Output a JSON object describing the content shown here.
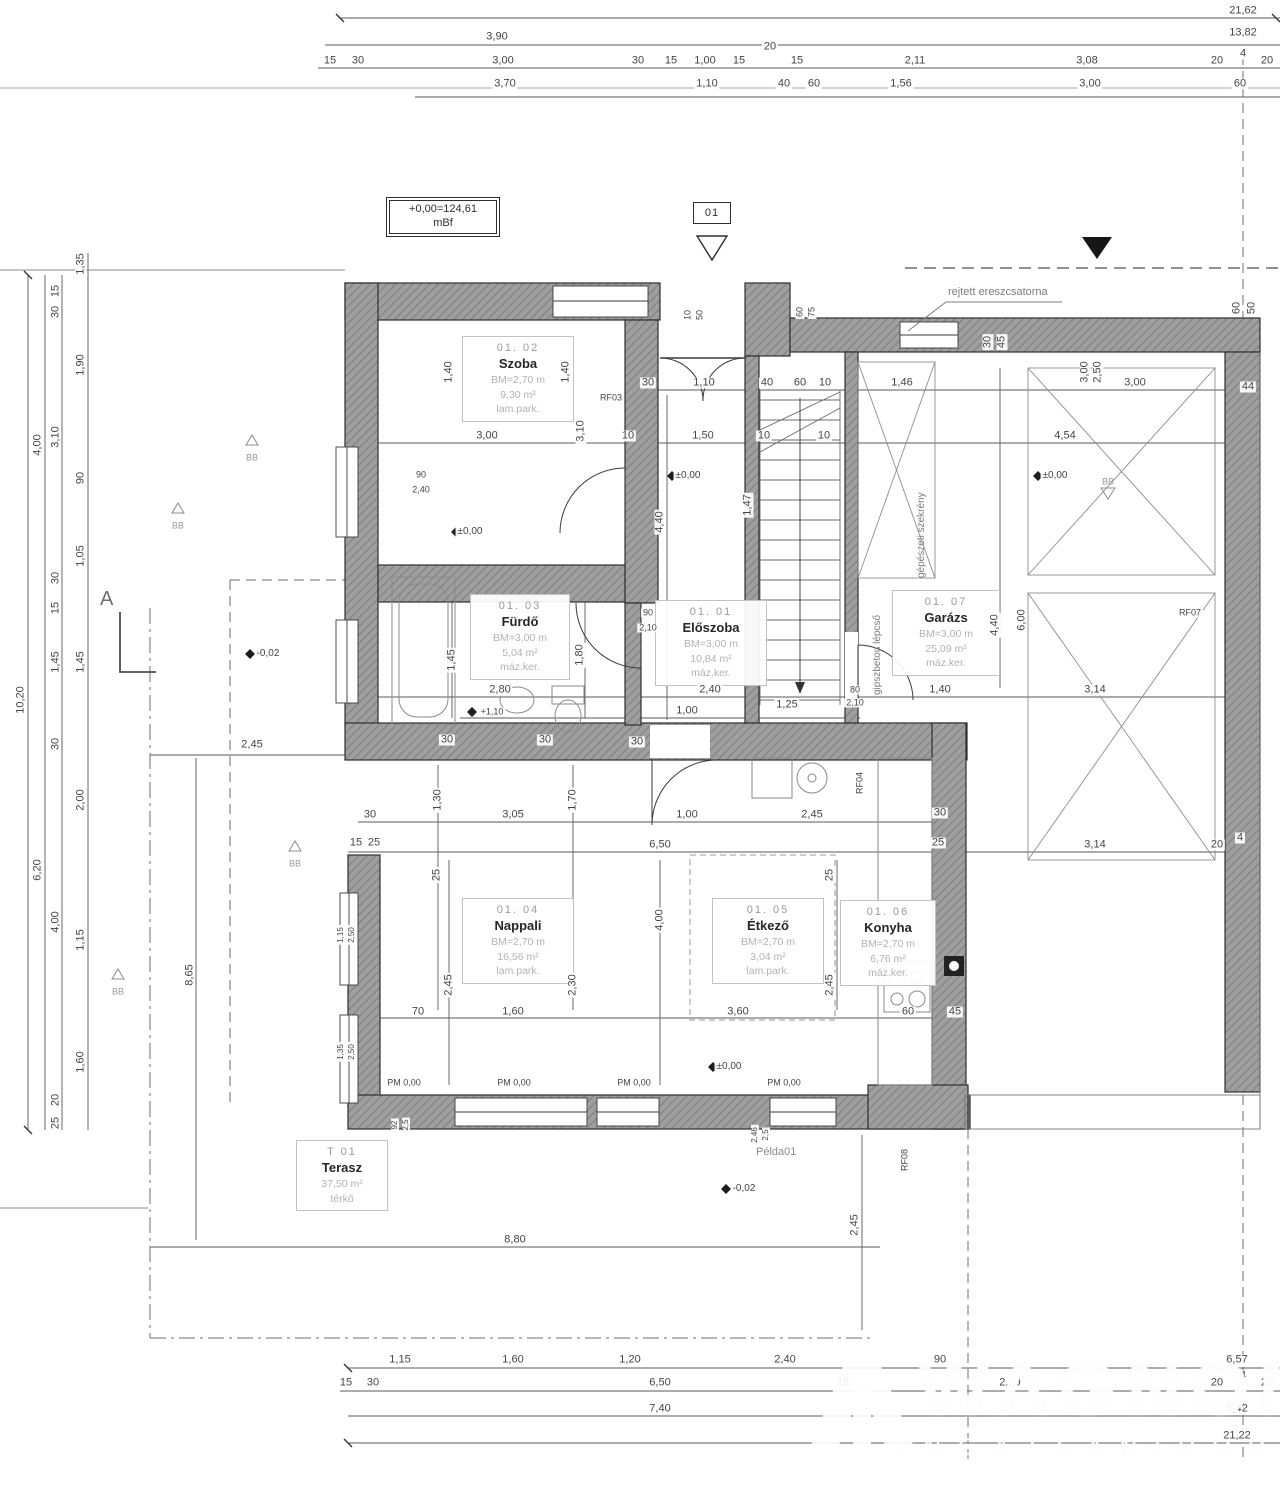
{
  "level_box": {
    "line1": "+0,00=124,61",
    "line2": "mBf"
  },
  "section_tag": "01",
  "section_letter": "A",
  "notes": {
    "gutter": "rejtett ereszcsatorna",
    "stairs": "gipszbeton lépcső",
    "closet": "gépészeti szekrény",
    "sample": "Példa01"
  },
  "watermark": {
    "line1": "WAGNON",
    "line2": "INGATLANIRODA"
  },
  "colors": {
    "wall_fill": "#9f9f9f",
    "wall_hatch": "#878787",
    "line": "#555555",
    "text": "#454545",
    "muted": "#a8a8a8"
  },
  "rooms": [
    {
      "num": "01. 01",
      "name": "Előszoba",
      "height": "BM=3,00 m",
      "area": "10,84 m²",
      "floor": "máz.ker."
    },
    {
      "num": "01. 02",
      "name": "Szoba",
      "height": "BM=2,70 m",
      "area": "9,30 m²",
      "floor": "lam.park."
    },
    {
      "num": "01. 03",
      "name": "Fürdő",
      "height": "BM=3,00 m",
      "area": "5,04 m²",
      "floor": "máz.ker."
    },
    {
      "num": "01. 04",
      "name": "Nappali",
      "height": "BM=2,70 m",
      "area": "16,56 m²",
      "floor": "lam.park."
    },
    {
      "num": "01. 05",
      "name": "Étkező",
      "height": "BM=2,70 m",
      "area": "3,04 m²",
      "floor": "lam.park."
    },
    {
      "num": "01. 06",
      "name": "Konyha",
      "height": "BM=2,70 m",
      "area": "6,76 m²",
      "floor": "máz.ker."
    },
    {
      "num": "01. 07",
      "name": "Garázs",
      "height": "BM=3,00 m",
      "area": "25,09 m²",
      "floor": "máz.ker."
    },
    {
      "num": "T 01",
      "name": "Terasz",
      "height": "",
      "area": "37,50 m²",
      "floor": "térkő"
    }
  ],
  "dims": [
    [
      1243,
      11,
      "21,62"
    ],
    [
      497,
      37,
      "3,90"
    ],
    [
      1243,
      33,
      "13,82"
    ],
    [
      330,
      61,
      "15"
    ],
    [
      358,
      61,
      "30"
    ],
    [
      503,
      61,
      "3,00"
    ],
    [
      638,
      61,
      "30"
    ],
    [
      671,
      61,
      "15"
    ],
    [
      705,
      61,
      "1,00"
    ],
    [
      739,
      61,
      "15"
    ],
    [
      770,
      47,
      "20"
    ],
    [
      797,
      61,
      "15"
    ],
    [
      915,
      61,
      "2,11"
    ],
    [
      1087,
      61,
      "3,08"
    ],
    [
      1217,
      61,
      "20"
    ],
    [
      1243,
      54,
      "4"
    ],
    [
      1267,
      61,
      "20"
    ],
    [
      505,
      84,
      "3,70"
    ],
    [
      707,
      84,
      "1,10"
    ],
    [
      784,
      84,
      "40"
    ],
    [
      814,
      84,
      "60"
    ],
    [
      901,
      84,
      "1,56"
    ],
    [
      1090,
      84,
      "3,00"
    ],
    [
      1240,
      84,
      "60"
    ],
    [
      21,
      700,
      "10,20",
      1
    ],
    [
      38,
      445,
      "4,00",
      1
    ],
    [
      38,
      870,
      "6,20",
      1
    ],
    [
      56,
      291,
      "15",
      1
    ],
    [
      56,
      312,
      "30",
      1
    ],
    [
      56,
      437,
      "3,10",
      1
    ],
    [
      56,
      578,
      "30",
      1
    ],
    [
      56,
      608,
      "15",
      1
    ],
    [
      56,
      662,
      "1,45",
      1
    ],
    [
      56,
      744,
      "30",
      1
    ],
    [
      56,
      922,
      "4,00",
      1
    ],
    [
      56,
      1100,
      "20",
      1
    ],
    [
      56,
      1123,
      "25",
      1
    ],
    [
      81,
      264,
      "1,35",
      1
    ],
    [
      81,
      365,
      "1,90",
      1
    ],
    [
      81,
      478,
      "90",
      1
    ],
    [
      81,
      556,
      "1,05",
      1
    ],
    [
      81,
      662,
      "1,45",
      1
    ],
    [
      81,
      800,
      "2,00",
      1
    ],
    [
      81,
      940,
      "1,15",
      1
    ],
    [
      81,
      1062,
      "1,60",
      1
    ],
    [
      400,
      1360,
      "1,15"
    ],
    [
      513,
      1360,
      "1,60"
    ],
    [
      630,
      1360,
      "1,20"
    ],
    [
      785,
      1360,
      "2,40"
    ],
    [
      940,
      1360,
      "90"
    ],
    [
      1237,
      1360,
      "6,57"
    ],
    [
      346,
      1383,
      "15"
    ],
    [
      373,
      1383,
      "30"
    ],
    [
      660,
      1383,
      "6,50"
    ],
    [
      843,
      1383,
      "15"
    ],
    [
      1010,
      1383,
      "2,19"
    ],
    [
      1217,
      1383,
      "20"
    ],
    [
      1243,
      1376,
      "4"
    ],
    [
      1267,
      1383,
      "20"
    ],
    [
      660,
      1409,
      "7,40"
    ],
    [
      1237,
      1409,
      "6,42"
    ],
    [
      1237,
      1436,
      "21,22"
    ],
    [
      252,
      745,
      "2,45"
    ],
    [
      190,
      975,
      "8,65",
      1
    ],
    [
      515,
      1240,
      "8,80"
    ],
    [
      855,
      1225,
      "2,45",
      1
    ],
    [
      648,
      383,
      "30"
    ],
    [
      704,
      383,
      "1,10"
    ],
    [
      767,
      383,
      "40"
    ],
    [
      800,
      383,
      "60"
    ],
    [
      825,
      383,
      "10"
    ],
    [
      902,
      383,
      "1,46"
    ],
    [
      1135,
      383,
      "3,00"
    ],
    [
      1248,
      387,
      "44"
    ],
    [
      487,
      436,
      "3,00"
    ],
    [
      581,
      431,
      "3,10",
      1
    ],
    [
      628,
      436,
      "10"
    ],
    [
      703,
      436,
      "1,50"
    ],
    [
      764,
      436,
      "10"
    ],
    [
      824,
      436,
      "10"
    ],
    [
      1065,
      436,
      "4,54"
    ],
    [
      449,
      372,
      "1,40",
      1
    ],
    [
      566,
      372,
      "1,40",
      1
    ],
    [
      660,
      522,
      "4,40",
      1
    ],
    [
      748,
      505,
      "1,47",
      1
    ],
    [
      452,
      660,
      "1,45",
      1
    ],
    [
      580,
      655,
      "1,80",
      1
    ],
    [
      995,
      625,
      "4,40",
      1
    ],
    [
      1022,
      620,
      "6,00",
      1
    ],
    [
      1237,
      308,
      "60",
      1
    ],
    [
      1252,
      308,
      "50",
      1
    ],
    [
      1085,
      372,
      "3,00",
      1
    ],
    [
      1098,
      372,
      "2,50",
      1
    ],
    [
      988,
      342,
      "30",
      1
    ],
    [
      1002,
      342,
      "45",
      1
    ],
    [
      688,
      315,
      "10",
      1,
      9
    ],
    [
      700,
      315,
      "50",
      1,
      9
    ],
    [
      800,
      312,
      "60",
      1,
      9
    ],
    [
      812,
      312,
      "75",
      1,
      9
    ],
    [
      611,
      398,
      "RF03",
      0,
      9
    ],
    [
      648,
      613,
      "90",
      0,
      9
    ],
    [
      648,
      628,
      "2,10",
      0,
      9
    ],
    [
      855,
      690,
      "80",
      0,
      9
    ],
    [
      855,
      703,
      "2,10",
      0,
      9
    ],
    [
      421,
      475,
      "90",
      0,
      9
    ],
    [
      421,
      490,
      "2,40",
      0,
      9
    ],
    [
      500,
      690,
      "2,80"
    ],
    [
      710,
      690,
      "2,40"
    ],
    [
      940,
      690,
      "1,40"
    ],
    [
      1095,
      690,
      "3,14"
    ],
    [
      687,
      711,
      "1,00"
    ],
    [
      787,
      705,
      "1,25"
    ],
    [
      492,
      712,
      "+1,10",
      0,
      9
    ],
    [
      447,
      740,
      "30"
    ],
    [
      545,
      740,
      "30"
    ],
    [
      637,
      742,
      "30"
    ],
    [
      940,
      813,
      "30"
    ],
    [
      370,
      815,
      "30"
    ],
    [
      356,
      843,
      "15"
    ],
    [
      374,
      843,
      "25"
    ],
    [
      513,
      815,
      "3,05"
    ],
    [
      687,
      815,
      "1,00"
    ],
    [
      812,
      815,
      "2,45"
    ],
    [
      573,
      800,
      "1,70",
      1
    ],
    [
      438,
      800,
      "1,30",
      1
    ],
    [
      660,
      845,
      "6,50"
    ],
    [
      938,
      843,
      "25"
    ],
    [
      1095,
      845,
      "3,14"
    ],
    [
      1217,
      845,
      "20"
    ],
    [
      1240,
      838,
      "4"
    ],
    [
      437,
      875,
      "25",
      1
    ],
    [
      830,
      875,
      "25",
      1
    ],
    [
      660,
      920,
      "4,00",
      1
    ],
    [
      449,
      985,
      "2,45",
      1
    ],
    [
      573,
      985,
      "2,30",
      1
    ],
    [
      830,
      985,
      "2,45",
      1
    ],
    [
      418,
      1012,
      "70"
    ],
    [
      513,
      1012,
      "1,60"
    ],
    [
      738,
      1012,
      "3,60"
    ],
    [
      908,
      1012,
      "60"
    ],
    [
      955,
      1012,
      "45"
    ],
    [
      404,
      1083,
      "PM 0,00",
      0,
      9
    ],
    [
      514,
      1083,
      "PM 0,00",
      0,
      9
    ],
    [
      634,
      1083,
      "PM 0,00",
      0,
      9
    ],
    [
      784,
      1083,
      "PM 0,00",
      0,
      9
    ],
    [
      470,
      532,
      "±0,00",
      0,
      10
    ],
    [
      688,
      476,
      "±0,00",
      0,
      10
    ],
    [
      1055,
      476,
      "±0,00",
      0,
      10
    ],
    [
      729,
      1067,
      "±0,00",
      0,
      10
    ],
    [
      268,
      654,
      "-0,02",
      0,
      10
    ],
    [
      744,
      1189,
      "-0,02",
      0,
      10
    ],
    [
      1190,
      613,
      "RF07",
      0,
      9
    ],
    [
      860,
      783,
      "RF04",
      1,
      9
    ],
    [
      905,
      1160,
      "RF08",
      1,
      9
    ],
    [
      252,
      458,
      "BB",
      0,
      9,
      1
    ],
    [
      178,
      526,
      "BB",
      0,
      9,
      1
    ],
    [
      1108,
      482,
      "BB",
      0,
      9,
      1
    ],
    [
      295,
      864,
      "BB",
      0,
      9,
      1
    ],
    [
      118,
      992,
      "BB",
      0,
      9,
      1
    ],
    [
      341,
      935,
      "1,15",
      1,
      8
    ],
    [
      352,
      935,
      "2,50",
      1,
      8
    ],
    [
      341,
      1052,
      "1,35",
      1,
      8
    ],
    [
      352,
      1052,
      "2,50",
      1,
      8
    ],
    [
      395,
      1125,
      "92",
      1,
      8
    ],
    [
      406,
      1125,
      "2,5",
      1,
      8
    ],
    [
      755,
      1135,
      "2,46",
      1,
      8
    ],
    [
      766,
      1135,
      "2,5",
      1,
      8
    ]
  ]
}
